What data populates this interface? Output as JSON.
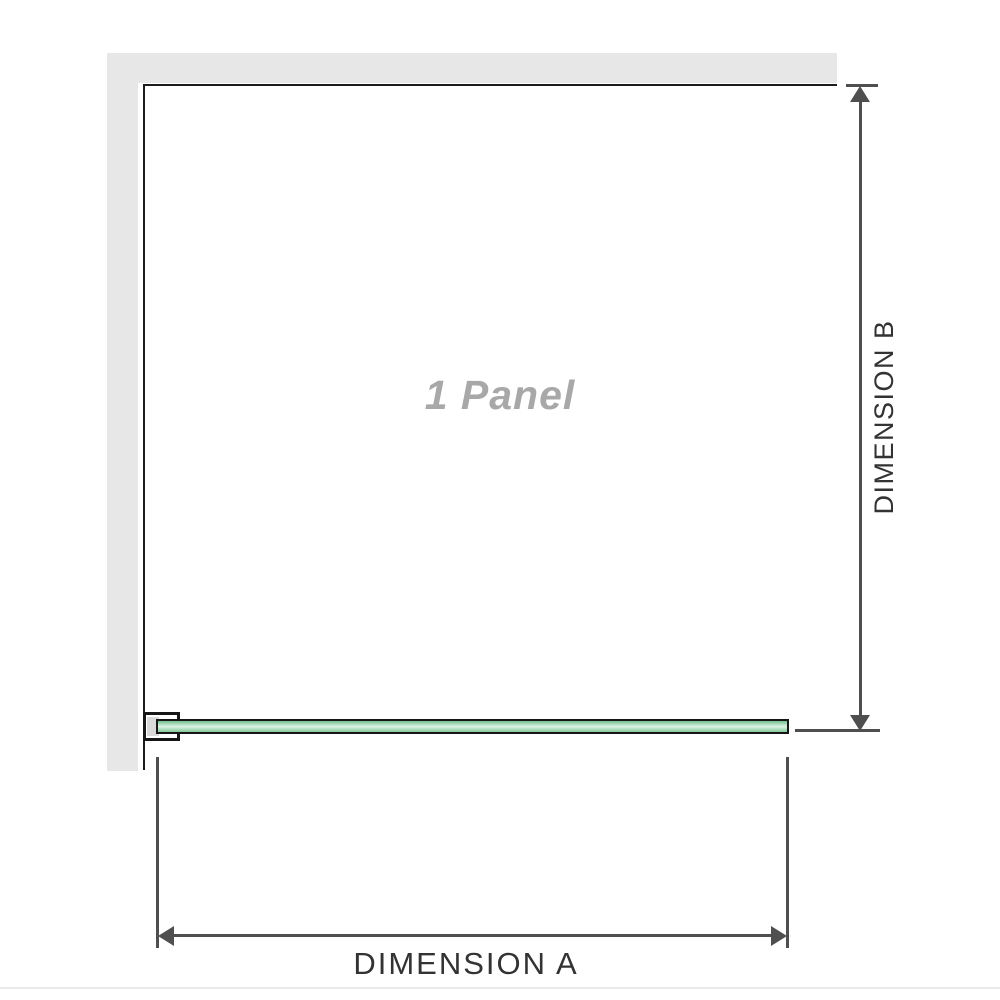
{
  "diagram": {
    "panel": {
      "label": "1 Panel"
    },
    "dimensions": {
      "a": {
        "label": "DIMENSION A"
      },
      "b": {
        "label": "DIMENSION B"
      }
    },
    "colors": {
      "wall": "#e7e7e7",
      "panel_outline": "#1c1c1c",
      "glass_green": "#85c898",
      "glass_green_light": "#ddf2e6",
      "glass_border": "#161616",
      "bracket_inner": "#d9d9d9",
      "dimension_line": "#4f4f4f",
      "dimension_text": "#333333",
      "panel_label_text": "#a8a8a8",
      "bottom_divider": "#ebebeb"
    }
  }
}
